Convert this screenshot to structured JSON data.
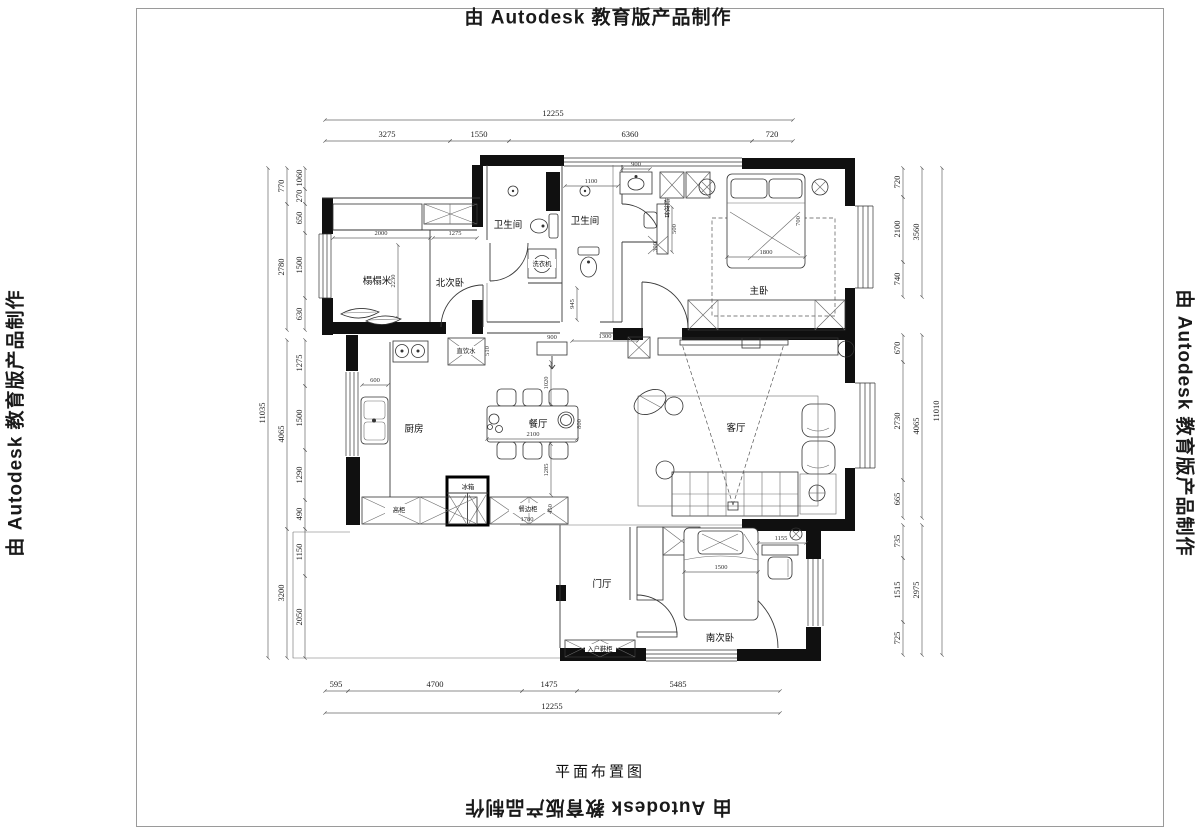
{
  "sheet": {
    "watermark": "由 Autodesk 教育版产品制作",
    "title": "平面布置图"
  },
  "rooms": {
    "bath1": "卫生间",
    "bath2": "卫生间",
    "tatami": "榻榻米",
    "north_bedroom": "北次卧",
    "master_bedroom": "主卧",
    "kitchen": "厨房",
    "dining": "餐厅",
    "living": "客厅",
    "hall": "门厅",
    "south_bedroom": "南次卧"
  },
  "furniture": {
    "washing_machine": "洗衣机",
    "dressing_table": "梳妆台",
    "water_point": "直饮水",
    "tall_cabinet": "高柜",
    "fridge": "冰箱",
    "sideboard": "餐边柜",
    "shoe_cabinet": "入户鞋柜"
  },
  "dims": {
    "top_total": "12255",
    "top": [
      "3275",
      "1550",
      "6360",
      "720"
    ],
    "bottom": [
      "595",
      "4700",
      "1475",
      "5485"
    ],
    "bottom_total": "12255",
    "left_outer": "11035",
    "left_mid": [
      "770",
      "2780",
      "4065",
      "3200"
    ],
    "left_inner": [
      "1060",
      "270",
      "650",
      "1500",
      "630",
      "1275",
      "1500",
      "1290",
      "490",
      "1150",
      "2050"
    ],
    "right_outer": "11010",
    "right_mid": [
      "3560",
      "4065",
      "2975"
    ],
    "right_inner": [
      "720",
      "2100",
      "740",
      "670",
      "2730",
      "665",
      "735",
      "1515",
      "725"
    ],
    "interior": {
      "tatami_w": "2000",
      "closet_w": "1275",
      "tatami_d": "2230",
      "corridor": "945",
      "bath2_w": "1100",
      "vanity": "900",
      "dresser": "500",
      "stool": "300",
      "bed_w": "1800",
      "pillow": "700",
      "cab": "900",
      "opening": "1300",
      "dining_n": "1020",
      "table_w": "2100",
      "table_d": "800",
      "dining_s": "1285",
      "counter": "600",
      "sideboard_w": "1780",
      "sideboard_d": "450",
      "water_d": "510",
      "sbed_w": "1500",
      "desk": "1155"
    }
  }
}
